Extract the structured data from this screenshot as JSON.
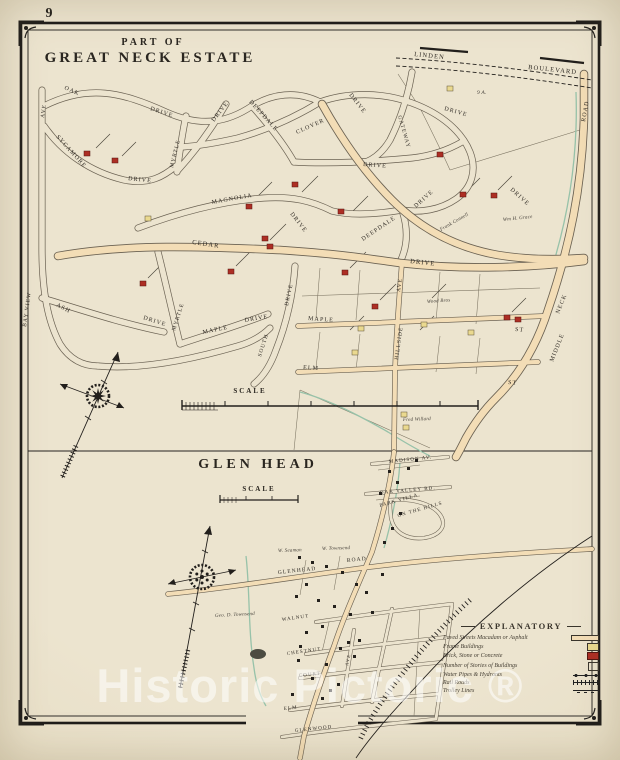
{
  "page": {
    "number": "9",
    "watermark_text": "Historic Pictoric ®"
  },
  "colors": {
    "paper": "#ece4cf",
    "ink": "#221f1c",
    "road_tan": "#f3ddb6",
    "brick_red": "#ad2e24",
    "frame_yellow": "#ead98f",
    "water_green": "#97c2a9"
  },
  "map1": {
    "title_line1": "PART OF",
    "title_line2": "GREAT NECK ESTATE",
    "scale_label": "SCALE",
    "streets": [
      {
        "t": "LINDEN",
        "x": 414,
        "y": 56,
        "r": 6,
        "s": 6.5
      },
      {
        "t": "BOULEVARD",
        "x": 528,
        "y": 69,
        "r": 6,
        "s": 6.5
      },
      {
        "t": "ROAD",
        "x": 585,
        "y": 122,
        "r": -80,
        "s": 6
      },
      {
        "t": "NECK",
        "x": 559,
        "y": 314,
        "r": -68,
        "s": 6
      },
      {
        "t": "MIDDLE",
        "x": 553,
        "y": 362,
        "r": -68,
        "s": 6
      },
      {
        "t": "OAK",
        "x": 64,
        "y": 89,
        "r": 24,
        "s": 6
      },
      {
        "t": "DRIVE",
        "x": 150,
        "y": 110,
        "r": 18,
        "s": 6
      },
      {
        "t": "AVE",
        "x": 44,
        "y": 118,
        "r": -82,
        "s": 5.5
      },
      {
        "t": "BAY VIEW",
        "x": 26,
        "y": 327,
        "r": -82,
        "s": 5.5
      },
      {
        "t": "SYCAMORE",
        "x": 56,
        "y": 137,
        "r": 48,
        "s": 6
      },
      {
        "t": "DRIVE",
        "x": 128,
        "y": 180,
        "r": 6,
        "s": 6
      },
      {
        "t": "MYRTLE",
        "x": 173,
        "y": 168,
        "r": -76,
        "s": 5.5
      },
      {
        "t": "DRIVE",
        "x": 214,
        "y": 122,
        "r": -52,
        "s": 6
      },
      {
        "t": "DEEPDALE",
        "x": 249,
        "y": 102,
        "r": 48,
        "s": 6
      },
      {
        "t": "CLOVER",
        "x": 297,
        "y": 134,
        "r": -24,
        "s": 6
      },
      {
        "t": "DRIVE",
        "x": 349,
        "y": 95,
        "r": 52,
        "s": 6
      },
      {
        "t": "GATEWAY",
        "x": 398,
        "y": 116,
        "r": 74,
        "s": 5.5
      },
      {
        "t": "DRIVE",
        "x": 363,
        "y": 166,
        "r": 4,
        "s": 6
      },
      {
        "t": "DRIVE",
        "x": 444,
        "y": 110,
        "r": 16,
        "s": 6
      },
      {
        "t": "DRIVE",
        "x": 510,
        "y": 190,
        "r": 42,
        "s": 6
      },
      {
        "t": "MAGNOLIA",
        "x": 212,
        "y": 204,
        "r": -10,
        "s": 6
      },
      {
        "t": "DRIVE",
        "x": 290,
        "y": 214,
        "r": 52,
        "s": 6
      },
      {
        "t": "CEDAR",
        "x": 192,
        "y": 244,
        "r": 8,
        "s": 6.5
      },
      {
        "t": "DRIVE",
        "x": 410,
        "y": 263,
        "r": 6,
        "s": 6.5
      },
      {
        "t": "DEEPDALE",
        "x": 363,
        "y": 241,
        "r": -34,
        "s": 6
      },
      {
        "t": "DRIVE",
        "x": 416,
        "y": 208,
        "r": -42,
        "s": 6
      },
      {
        "t": "ASH",
        "x": 56,
        "y": 306,
        "r": 28,
        "s": 6
      },
      {
        "t": "DRIVE",
        "x": 143,
        "y": 319,
        "r": 18,
        "s": 6
      },
      {
        "t": "MYRTLE",
        "x": 175,
        "y": 331,
        "r": -72,
        "s": 5.5
      },
      {
        "t": "MAPLE",
        "x": 203,
        "y": 334,
        "r": -12,
        "s": 6
      },
      {
        "t": "DRIVE",
        "x": 245,
        "y": 322,
        "r": -10,
        "s": 6
      },
      {
        "t": "SOUTH",
        "x": 261,
        "y": 357,
        "r": -72,
        "s": 5.5
      },
      {
        "t": "DRIVE",
        "x": 288,
        "y": 306,
        "r": -78,
        "s": 5.5
      },
      {
        "t": "MAPLE",
        "x": 308,
        "y": 320,
        "r": 4,
        "s": 6
      },
      {
        "t": "ST",
        "x": 515,
        "y": 331,
        "r": 4,
        "s": 6
      },
      {
        "t": "ELM",
        "x": 303,
        "y": 369,
        "r": 4,
        "s": 6
      },
      {
        "t": "ST",
        "x": 508,
        "y": 384,
        "r": 4,
        "s": 6
      },
      {
        "t": "HILLSIDE",
        "x": 398,
        "y": 360,
        "r": -82,
        "s": 5.5
      },
      {
        "t": "AVE",
        "x": 400,
        "y": 292,
        "r": -82,
        "s": 5.5
      }
    ],
    "owners": [
      {
        "t": "Frank Connell",
        "x": 441,
        "y": 231,
        "r": -30,
        "s": 5
      },
      {
        "t": "Wm H. Grace",
        "x": 503,
        "y": 221,
        "r": -6,
        "s": 5
      },
      {
        "t": "Wood Bros",
        "x": 427,
        "y": 303,
        "r": -4,
        "s": 5
      },
      {
        "t": "Fred Willard",
        "x": 403,
        "y": 421,
        "r": -2,
        "s": 5
      },
      {
        "t": "9 A.",
        "x": 477,
        "y": 94,
        "r": 0,
        "s": 5.5
      }
    ],
    "buildings_brick": [
      [
        84,
        151
      ],
      [
        112,
        158
      ],
      [
        292,
        182
      ],
      [
        246,
        204
      ],
      [
        338,
        209
      ],
      [
        262,
        236
      ],
      [
        267,
        244
      ],
      [
        228,
        269
      ],
      [
        140,
        281
      ],
      [
        342,
        270
      ],
      [
        437,
        152
      ],
      [
        460,
        192
      ],
      [
        491,
        193
      ],
      [
        372,
        304
      ],
      [
        504,
        315
      ],
      [
        515,
        317
      ]
    ],
    "buildings_frame": [
      [
        447,
        86
      ],
      [
        145,
        216
      ],
      [
        358,
        326
      ],
      [
        421,
        322
      ],
      [
        401,
        412
      ],
      [
        403,
        425
      ],
      [
        468,
        330
      ],
      [
        352,
        350
      ]
    ]
  },
  "map2": {
    "title": "GLEN HEAD",
    "scale_label": "SCALE",
    "streets": [
      {
        "t": "MADISON AV.",
        "x": 389,
        "y": 463,
        "r": -6,
        "s": 5
      },
      {
        "t": "OAK VALLEY RD.",
        "x": 380,
        "y": 494,
        "r": -5,
        "s": 5
      },
      {
        "t": "PARK VILLA",
        "x": 380,
        "y": 507,
        "r": -16,
        "s": 5
      },
      {
        "t": "ON THE HILLS",
        "x": 398,
        "y": 517,
        "r": -16,
        "s": 5
      },
      {
        "t": "GLENHEAD",
        "x": 278,
        "y": 574,
        "r": -6,
        "s": 5.5
      },
      {
        "t": "ROAD",
        "x": 347,
        "y": 562,
        "r": -6,
        "s": 5.5
      },
      {
        "t": "WALNUT",
        "x": 282,
        "y": 621,
        "r": -8,
        "s": 5
      },
      {
        "t": "CHESTNUT",
        "x": 287,
        "y": 655,
        "r": -8,
        "s": 5
      },
      {
        "t": "COURT",
        "x": 299,
        "y": 677,
        "r": -6,
        "s": 5
      },
      {
        "t": "ELM",
        "x": 284,
        "y": 710,
        "r": -6,
        "s": 5
      },
      {
        "t": "GLENWOOD",
        "x": 295,
        "y": 732,
        "r": -6,
        "s": 5
      },
      {
        "t": "AVE",
        "x": 348,
        "y": 666,
        "r": -78,
        "s": 4.5
      }
    ],
    "owners": [
      {
        "t": "W. Seaman",
        "x": 278,
        "y": 552,
        "r": -2,
        "s": 5
      },
      {
        "t": "W. Townsend",
        "x": 322,
        "y": 550,
        "r": -2,
        "s": 5
      },
      {
        "t": "Geo. D. Townsend",
        "x": 215,
        "y": 617,
        "r": -3,
        "s": 5
      }
    ],
    "buildings": [
      [
        388,
        470
      ],
      [
        396,
        481
      ],
      [
        379,
        492
      ],
      [
        399,
        512
      ],
      [
        391,
        527
      ],
      [
        383,
        541
      ],
      [
        298,
        556
      ],
      [
        311,
        561
      ],
      [
        325,
        565
      ],
      [
        341,
        571
      ],
      [
        355,
        583
      ],
      [
        365,
        591
      ],
      [
        305,
        583
      ],
      [
        295,
        595
      ],
      [
        317,
        599
      ],
      [
        333,
        605
      ],
      [
        349,
        613
      ],
      [
        321,
        625
      ],
      [
        305,
        631
      ],
      [
        339,
        647
      ],
      [
        353,
        655
      ],
      [
        297,
        659
      ],
      [
        325,
        663
      ],
      [
        311,
        677
      ],
      [
        337,
        683
      ],
      [
        291,
        693
      ],
      [
        321,
        697
      ],
      [
        347,
        641
      ],
      [
        371,
        611
      ],
      [
        381,
        573
      ],
      [
        407,
        467
      ],
      [
        415,
        459
      ],
      [
        358,
        639
      ],
      [
        299,
        645
      ],
      [
        329,
        689
      ]
    ]
  },
  "legend": {
    "title": "EXPLANATORY",
    "rows": [
      {
        "label": "Paved Streets Macadam or Asphalt",
        "sym": "paved"
      },
      {
        "label": "Frame Buildings",
        "sym": "frame"
      },
      {
        "label": "Brick, Stone or Concrete",
        "sym": "brick"
      },
      {
        "label": "Number of Stories of Buildings",
        "sym": "stories"
      },
      {
        "label": "Water Pipes & Hydrants",
        "sym": "water"
      },
      {
        "label": "Rail Roads",
        "sym": "rail"
      },
      {
        "label": "Trolley Lines",
        "sym": "trolley"
      }
    ]
  }
}
